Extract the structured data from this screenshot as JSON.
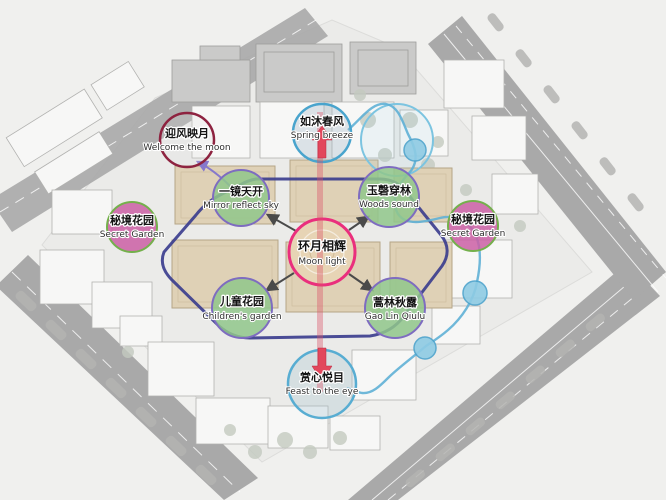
{
  "diagram": {
    "type": "residential landscape master plan with themed garden nodes",
    "nodes": {
      "welcome_moon": {
        "zh": "迎风映月",
        "en": "Welcome the moon",
        "ring": "#8e2340"
      },
      "spring_breeze": {
        "zh": "如沐春风",
        "en": "Spring breeze",
        "ring": "#49a4cd"
      },
      "mirror_sky": {
        "zh": "一镜天开",
        "en": "Mirror reflect sky",
        "ring": "#7e6cc0",
        "fill": "#90c78b"
      },
      "woods_sound": {
        "zh": "玉磬穿林",
        "en": "Woods sound",
        "ring": "#7e6cc0",
        "fill": "#90c78b"
      },
      "secret_garden_west": {
        "zh": "秘境花园",
        "en": "Secret Garden",
        "ring": "#74b04c",
        "fill": "#cb5fa4"
      },
      "secret_garden_east": {
        "zh": "秘境花园",
        "en": "Secret Garden",
        "ring": "#74b04c",
        "fill": "#cb5fa4"
      },
      "moon_light": {
        "zh": "环月相辉",
        "en": "Moon light",
        "ring": "#ea2f7d",
        "fill": "#e7d4b5"
      },
      "children_garden": {
        "zh": "儿童花园",
        "en": "Children's garden",
        "ring": "#7e6cc0",
        "fill": "#90c78b"
      },
      "gaolin_qiulu": {
        "zh": "蒿林秋露",
        "en": "Gao Lin Qiulu",
        "ring": "#7e6cc0",
        "fill": "#90c78b"
      },
      "feast_eye": {
        "zh": "赏心悦目",
        "en": "Feast to the eye",
        "ring": "#58add2"
      }
    },
    "colors": {
      "axis_red": "#e2475c",
      "water_route_blue": "#5fb0d6",
      "inner_loop_navy": "#3c3e8e",
      "connector_purple": "#8678cc",
      "radial_arrow_gray": "#4a4a4a",
      "site_beige": "#dfd1b6",
      "road_gray": "#a9a9a9"
    }
  }
}
